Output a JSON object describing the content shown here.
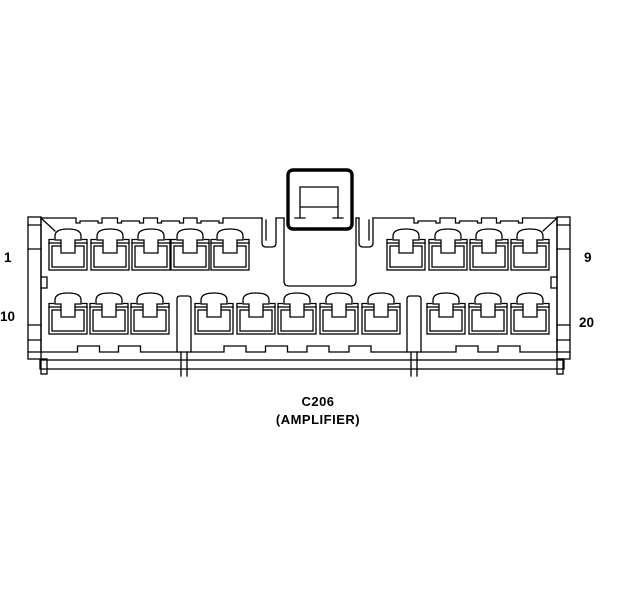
{
  "diagram": {
    "title": {
      "id_label": "C206",
      "name_label": "(AMPLIFIER)"
    },
    "labels": {
      "pin1": "1",
      "pin9": "9",
      "pin10": "10",
      "pin20": "20"
    },
    "colors": {
      "line": "#000000",
      "background": "#ffffff"
    },
    "geometry": {
      "top_row_pin_centers": [
        68,
        110,
        151,
        190,
        230,
        406,
        448,
        489,
        530
      ],
      "bottom_row_pin_centers": [
        68,
        109,
        150,
        214,
        256,
        297,
        339,
        381,
        446,
        488,
        530
      ],
      "top_edge_notch_centers": [
        89,
        130.5,
        170.5,
        210,
        427,
        468.5,
        509.5
      ],
      "bottom_edge_bump_centers": [
        88.5,
        129.5,
        235,
        276.5,
        318,
        360,
        467,
        509
      ],
      "divider_centers": [
        184,
        414
      ]
    }
  }
}
